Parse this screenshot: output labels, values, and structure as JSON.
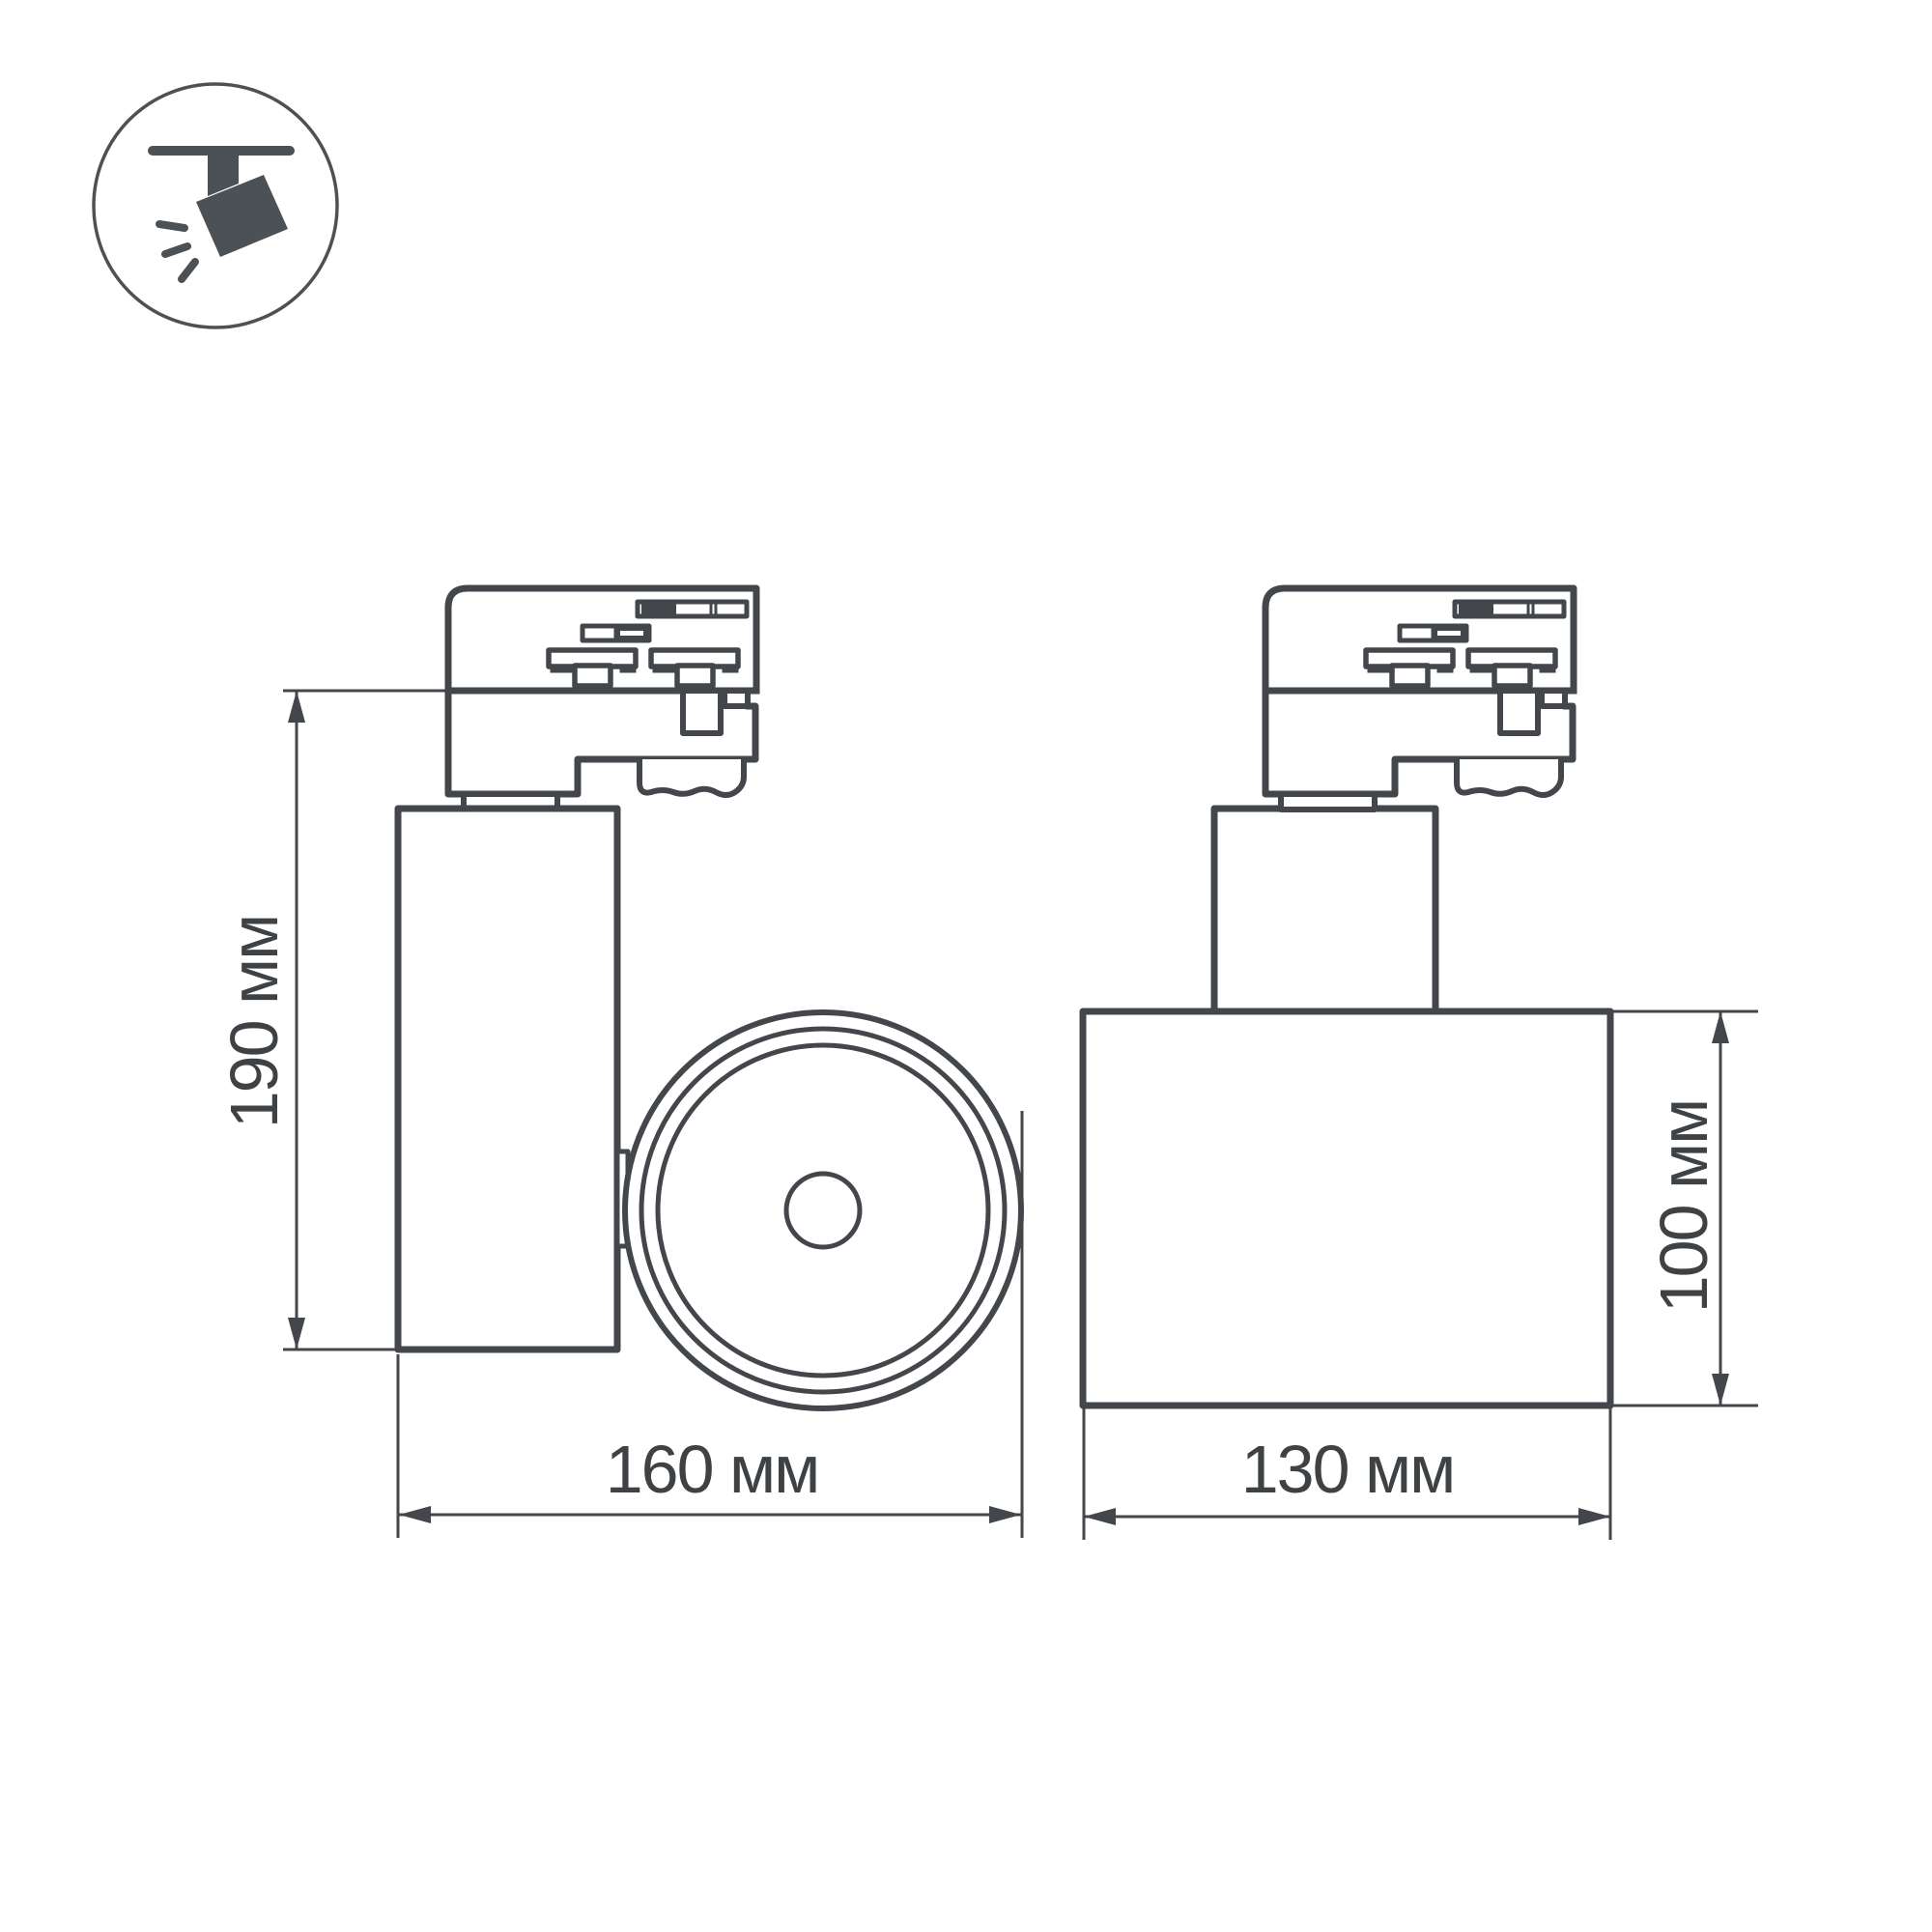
{
  "page": {
    "background_color": "#ffffff",
    "line_color": "#43474b",
    "icon_color": "#4c5156",
    "text_color": "#3e4245"
  },
  "icon": {
    "name": "track-spotlight-icon"
  },
  "views": {
    "side_view": {
      "dimensions": {
        "height": {
          "label": "190 мм"
        },
        "width": {
          "label": "160 мм"
        }
      }
    },
    "front_view": {
      "dimensions": {
        "width": {
          "label": "130 мм"
        },
        "height": {
          "label": "100 мм"
        }
      }
    }
  }
}
